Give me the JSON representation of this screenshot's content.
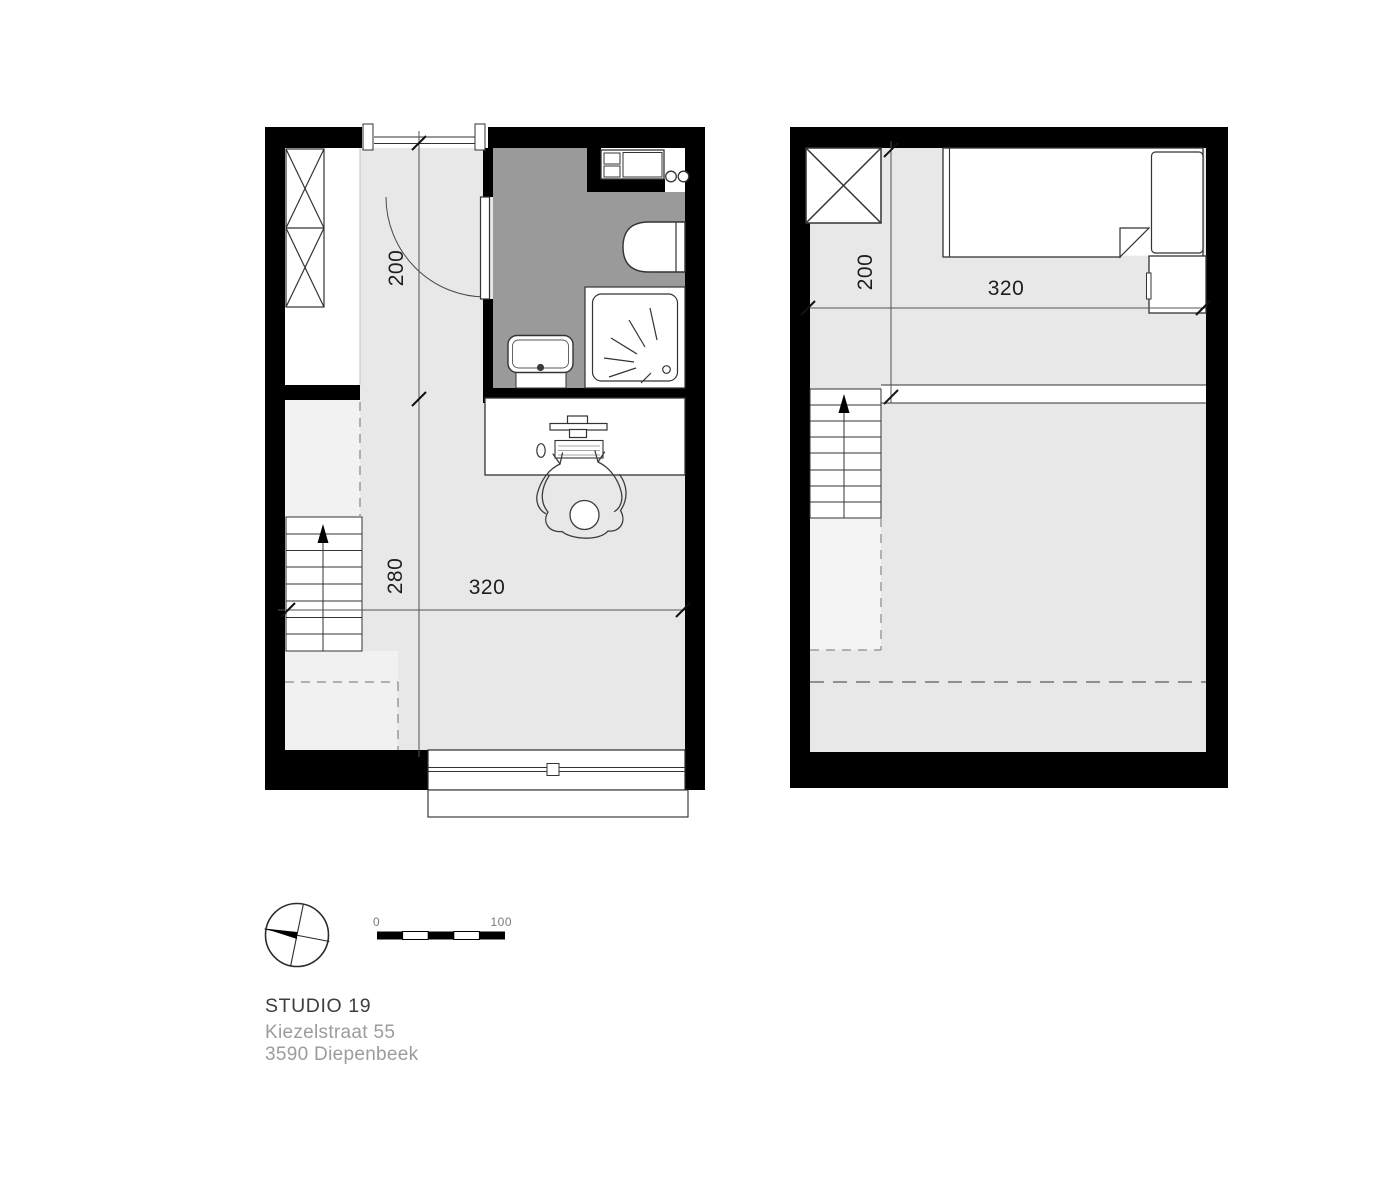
{
  "title_block": {
    "project": "STUDIO 19",
    "address_line1": "Kiezelstraat 55",
    "address_line2": "3590 Diepenbeek"
  },
  "scale_bar": {
    "start": "0",
    "end": "100"
  },
  "plans": {
    "ground_floor": {
      "dims": {
        "hall_width": "200",
        "room_depth": "280",
        "room_width": "320"
      }
    },
    "loft": {
      "dims": {
        "landing_width": "200",
        "room_width": "320"
      }
    }
  },
  "colors": {
    "wall": "#000000",
    "bathroom_floor": "#9a9a9a",
    "floor_main": "#e8e8e8",
    "floor_light": "#f2f2f2",
    "room_white": "#ffffff",
    "dash_line": "#9b9b9b",
    "text_primary": "#3e3e3e",
    "text_secondary": "#9c9c9c"
  }
}
